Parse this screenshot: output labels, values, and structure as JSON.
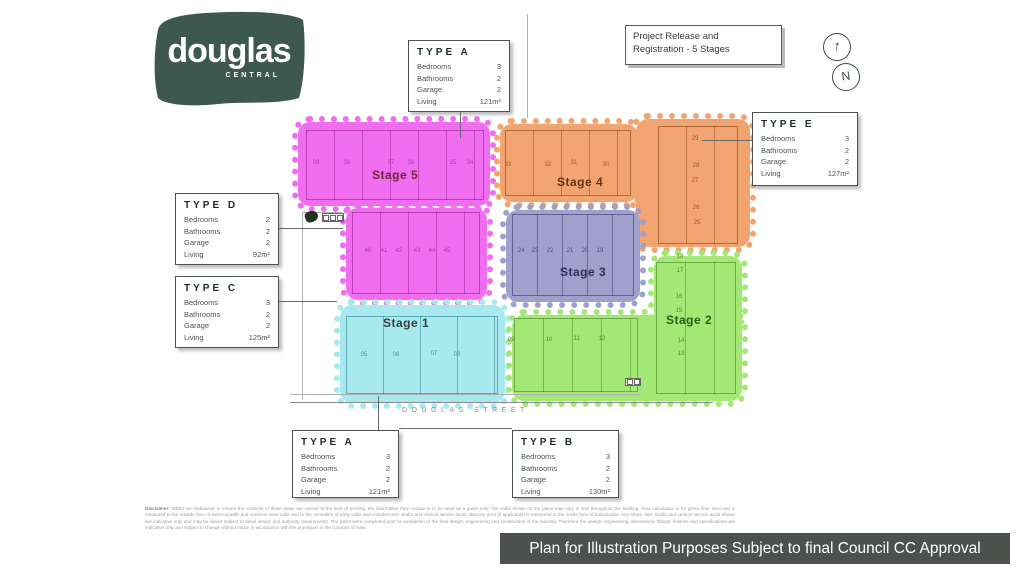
{
  "logo": {
    "brand": "douglas",
    "sub_brand": "CENTRAL",
    "brand_color": "#3d584e"
  },
  "annotations": {
    "project_box_line1": "Project Release and",
    "project_box_line2": "Registration - 5 Stages",
    "compass_arrow": "↑",
    "north_label": "N",
    "street_label": "DOUGLAS STREET",
    "banner_text": "Plan for Illustration Purposes Subject to final Council CC Approval",
    "banner_bg": "#4c514d"
  },
  "spec_labels": [
    "Bedrooms",
    "Bathrooms",
    "Garage",
    "Living"
  ],
  "type_boxes": {
    "a_top": {
      "title": "TYPE A",
      "values": [
        "3",
        "2",
        "2",
        "121m²"
      ]
    },
    "e": {
      "title": "TYPE E",
      "values": [
        "3",
        "2",
        "2",
        "127m²"
      ]
    },
    "d": {
      "title": "TYPE D",
      "values": [
        "2",
        "2",
        "2",
        "92m²"
      ]
    },
    "c": {
      "title": "TYPE C",
      "values": [
        "3",
        "2",
        "2",
        "125m²"
      ]
    },
    "a_bottom": {
      "title": "TYPE A",
      "values": [
        "3",
        "2",
        "2",
        "121m²"
      ]
    },
    "b": {
      "title": "TYPE B",
      "values": [
        "3",
        "2",
        "2",
        "130m²"
      ]
    }
  },
  "stages": {
    "s1": {
      "label": "Stage 1",
      "color": "#a8e9f0"
    },
    "s2": {
      "label": "Stage 2",
      "color": "#a3e874"
    },
    "s3": {
      "label": "Stage 3",
      "color": "#9fa0cb"
    },
    "s4": {
      "label": "Stage 4",
      "color": "#f2a470"
    },
    "s5": {
      "label": "Stage 5",
      "color": "#f06df0"
    }
  },
  "lots": {
    "s5_top": [
      "39",
      "38",
      "37",
      "36",
      "35",
      "34"
    ],
    "s5_mid": [
      "40",
      "41",
      "42",
      "43",
      "44",
      "45"
    ],
    "s4_row": [
      "33",
      "32",
      "31",
      "30"
    ],
    "s4_col": [
      "29",
      "28",
      "27",
      "26",
      "25"
    ],
    "s3_row": [
      "24",
      "23",
      "22",
      "21",
      "20",
      "19"
    ],
    "s1_row": [
      "05",
      "06",
      "07",
      "08"
    ],
    "s2_row": [
      "09",
      "10",
      "11",
      "12"
    ],
    "s2_col": [
      "18",
      "17",
      "16",
      "15",
      "14",
      "13"
    ]
  },
  "disclaimer": {
    "heading": "Disclaimer:",
    "body": " Whilst we endeavour to ensure the contents of these plans are correct at the time of printing, the information they contain is to be used as a guide only. The walls shown on the plans may vary in size throughout the building. Area calculation is for gross floor area and is measured to the outside face of external walls and common area walls and to the centreline of party walls and includes riser shafts and vertical service ducts. Balcony area (if applicable) is measured to the inside face of balustrades. Any areas, riser shafts and vertical service ducts shown are indicative only and may be varied subject to detail design and authority requirements. The plans were completed prior to completion of the final design, engineering and construction of the building. Therefore the design, engineering, dimensions, fittings, finishes and specifications are indicative only and subject to change without notice in accordance with the provisions in the Contract of Sale."
  }
}
